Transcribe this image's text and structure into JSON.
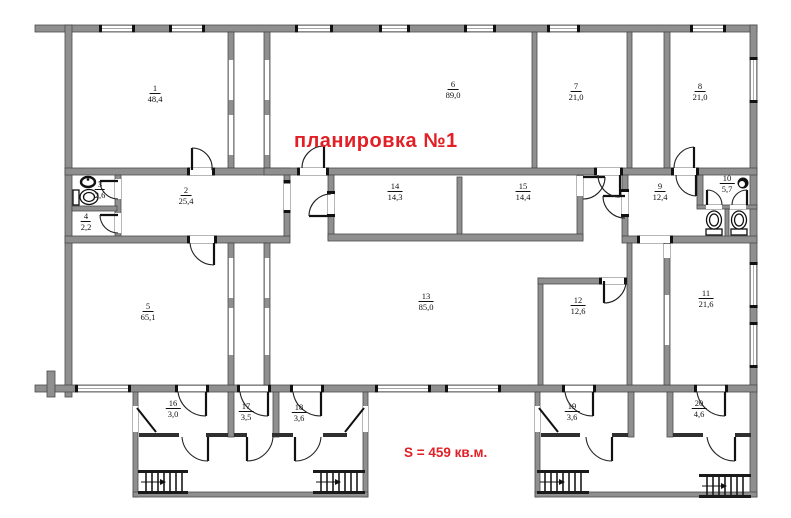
{
  "title": {
    "text": "планировка №1",
    "color": "#e21f26"
  },
  "area_note": {
    "text": "S = 459 кв.м.",
    "color": "#e21f26"
  },
  "colors": {
    "background": "#ffffff",
    "wall_fill": "#8f8f8f",
    "wall_stroke": "#4a4a4a",
    "accent": "#e21f26"
  },
  "rooms": [
    {
      "num": "1",
      "area": "48,4"
    },
    {
      "num": "2",
      "area": "25,4"
    },
    {
      "num": "3",
      "area": "2,6"
    },
    {
      "num": "4",
      "area": "2,2"
    },
    {
      "num": "5",
      "area": "65,1"
    },
    {
      "num": "6",
      "area": "89,0"
    },
    {
      "num": "7",
      "area": "21,0"
    },
    {
      "num": "8",
      "area": "21,0"
    },
    {
      "num": "9",
      "area": "12,4"
    },
    {
      "num": "10",
      "area": "5,7"
    },
    {
      "num": "11",
      "area": "21,6"
    },
    {
      "num": "12",
      "area": "12,6"
    },
    {
      "num": "13",
      "area": "85,0"
    },
    {
      "num": "14",
      "area": "14,3"
    },
    {
      "num": "15",
      "area": "14,4"
    },
    {
      "num": "16",
      "area": "3,0"
    },
    {
      "num": "17",
      "area": "3,5"
    },
    {
      "num": "18",
      "area": "3,6"
    },
    {
      "num": "19",
      "area": "3,6"
    },
    {
      "num": "20",
      "area": "4,6"
    }
  ]
}
